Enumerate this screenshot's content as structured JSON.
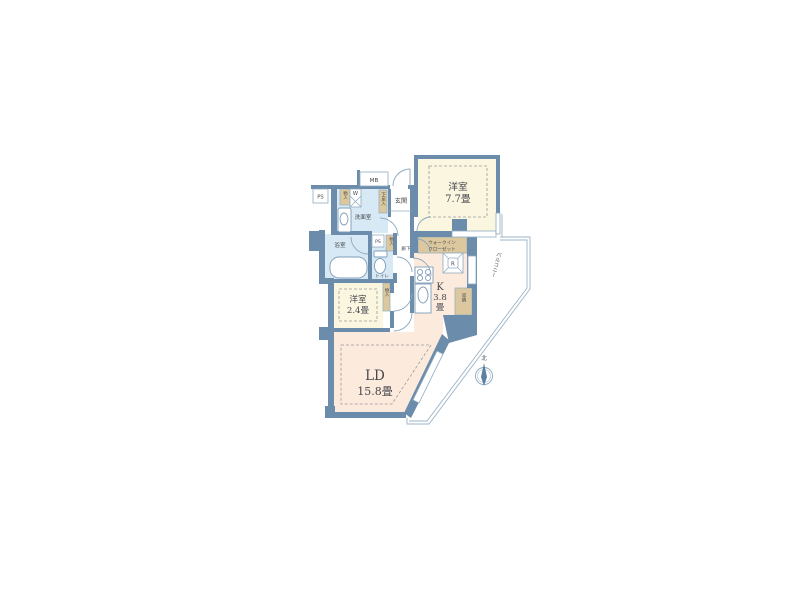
{
  "floorplan": {
    "labels": {
      "mb": "MB",
      "ps": "PS",
      "storage_small": "物入",
      "shoe_cabinet": "下足入",
      "entrance": "玄関",
      "washroom": "洗面室",
      "washer": "W",
      "bathroom": "浴室",
      "toilet": "トイレ",
      "hallway": "廊下",
      "wic_line1": "ウォークイン",
      "wic_line2": "クローゼット",
      "refrigerator": "R",
      "kitchen_letter": "K",
      "kitchen_size": "3.8",
      "kitchen_unit": "畳",
      "closet": "収納",
      "balcony": "バルコニー",
      "bedroom77_name": "洋室",
      "bedroom77_size": "7.7畳",
      "bedroom24_name": "洋室",
      "bedroom24_size": "2.4畳",
      "living_name": "LD",
      "living_size": "15.8畳",
      "north": "北"
    },
    "colors": {
      "wall": "#6b8caa",
      "room_cream": "#fbf6e0",
      "room_peach": "#fcebdd",
      "room_wet": "#d7e9f4",
      "closet_tan": "#dcc89e",
      "outline": "#9db4c7"
    }
  }
}
